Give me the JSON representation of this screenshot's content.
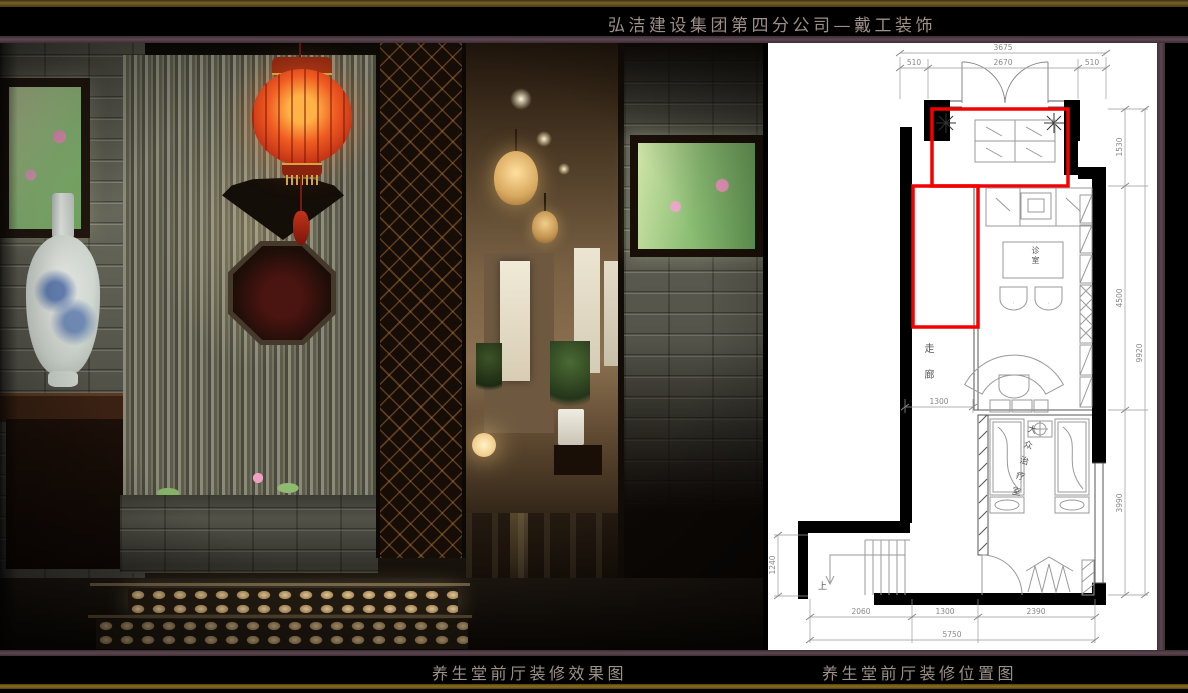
{
  "header": {
    "title": "弘洁建设集团第四分公司—戴工装饰"
  },
  "footer": {
    "left_caption": "养生堂前厅装修效果图",
    "right_caption": "养生堂前厅装修位置图"
  },
  "colors": {
    "frame_gold": "#75612c",
    "frame_maroon": "#5d4550",
    "title_text": "#9e8f88",
    "plan_highlight_red": "#f40000",
    "plan_background": "#ffffff",
    "lantern_red": "#c03014"
  },
  "floor_plan": {
    "dims": {
      "top_total": "3675",
      "top_left": "510",
      "top_mid": "2670",
      "top_right": "510",
      "right_1": "1530",
      "right_2": "4500",
      "right_3": "3990",
      "right_total": "9920",
      "bottom_1": "2060",
      "bottom_2": "1300",
      "bottom_3": "2390",
      "bottom_total": "5750",
      "left_1": "1240",
      "inner_1": "1300"
    },
    "labels": {
      "treatment_room": "大众治疗室",
      "corridor": "走廊",
      "desk": "诊室",
      "stairs_up": "上"
    }
  }
}
